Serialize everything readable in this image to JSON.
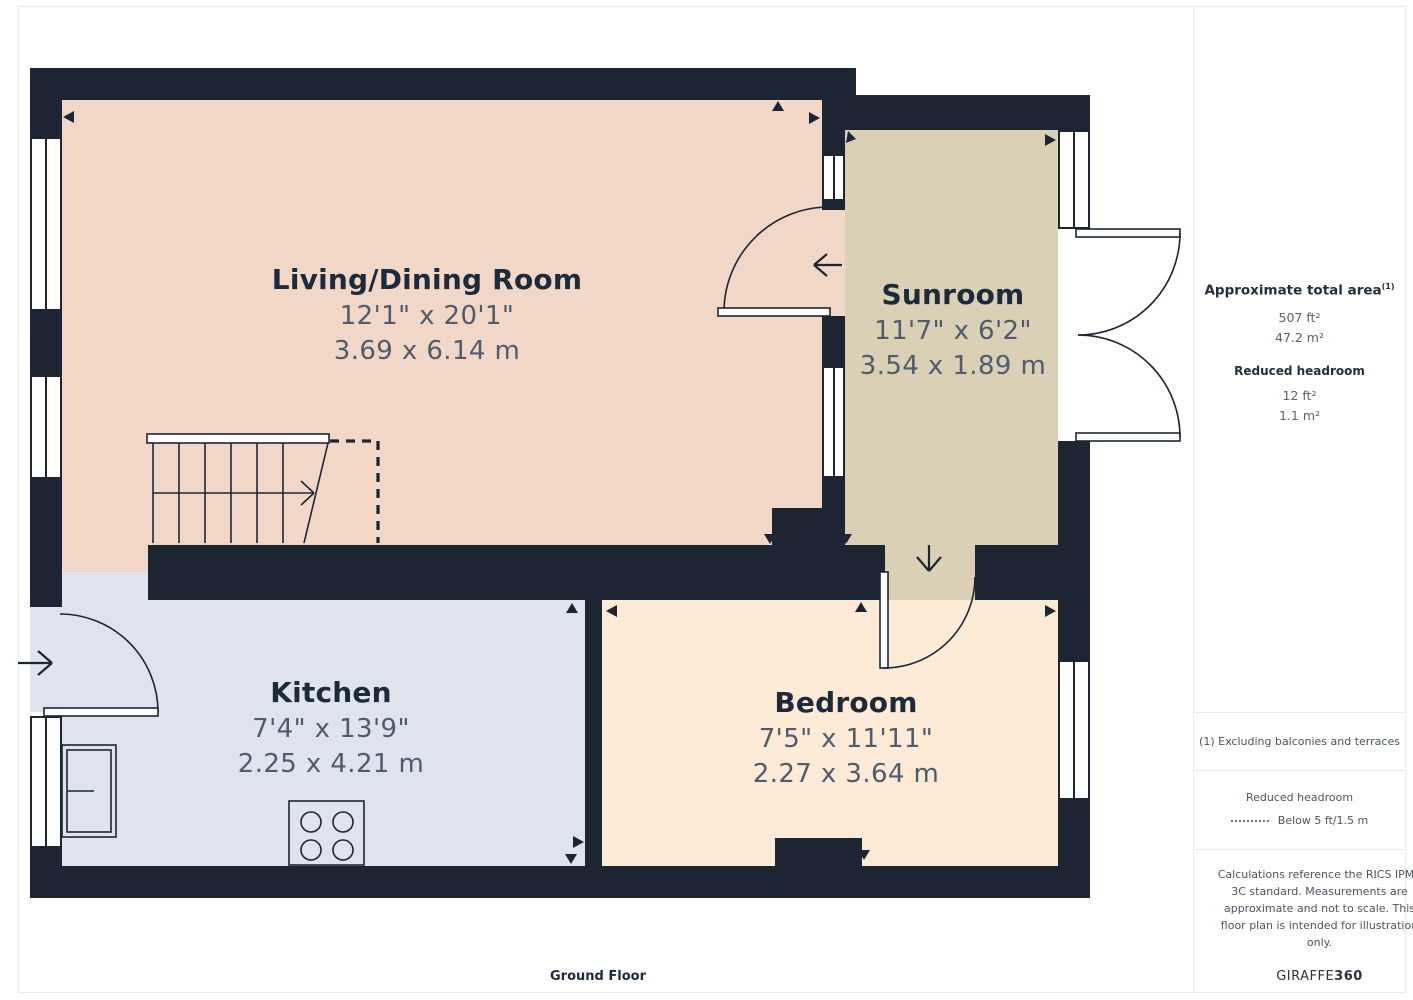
{
  "floor_label": "Ground Floor",
  "rooms": [
    {
      "id": "living",
      "name": "Living/Dining Room",
      "dim_ft": "12'1\" x 20'1\"",
      "dim_m": "3.69 x 6.14 m",
      "color": "#f1d7c7"
    },
    {
      "id": "sunroom",
      "name": "Sunroom",
      "dim_ft": "11'7\" x 6'2\"",
      "dim_m": "3.54 x 1.89 m",
      "color": "#d9d0b5"
    },
    {
      "id": "kitchen",
      "name": "Kitchen",
      "dim_ft": "7'4\" x 13'9\"",
      "dim_m": "2.25 x 4.21 m",
      "color": "#dfe3ee"
    },
    {
      "id": "bedroom",
      "name": "Bedroom",
      "dim_ft": "7'5\" x 11'11\"",
      "dim_m": "2.27 x 3.64 m",
      "color": "#fdead7"
    }
  ],
  "sidebar": {
    "total_area_label": "Approximate total area",
    "total_area_superscript": "(1)",
    "total_area_ft": "507 ft²",
    "total_area_m": "47.2 m²",
    "reduced_headroom_label": "Reduced headroom",
    "reduced_headroom_ft": "12 ft²",
    "reduced_headroom_m": "1.1 m²",
    "note_exclusions": "(1) Excluding balconies and terraces",
    "legend_title": "Reduced headroom",
    "legend_value": "Below 5 ft/1.5 m",
    "disclaimer": "Calculations reference the RICS IPMS 3C standard. Measurements are approximate and not to scale. This floor plan is intended for illustration only.",
    "brand_name": "GIRAFFE",
    "brand_suffix": "360"
  },
  "colors": {
    "wall": "#1d2533",
    "room_title_text": "#1c2a3a",
    "dimension_text": "#4f5c6e",
    "panel_border": "#e9ebee"
  }
}
